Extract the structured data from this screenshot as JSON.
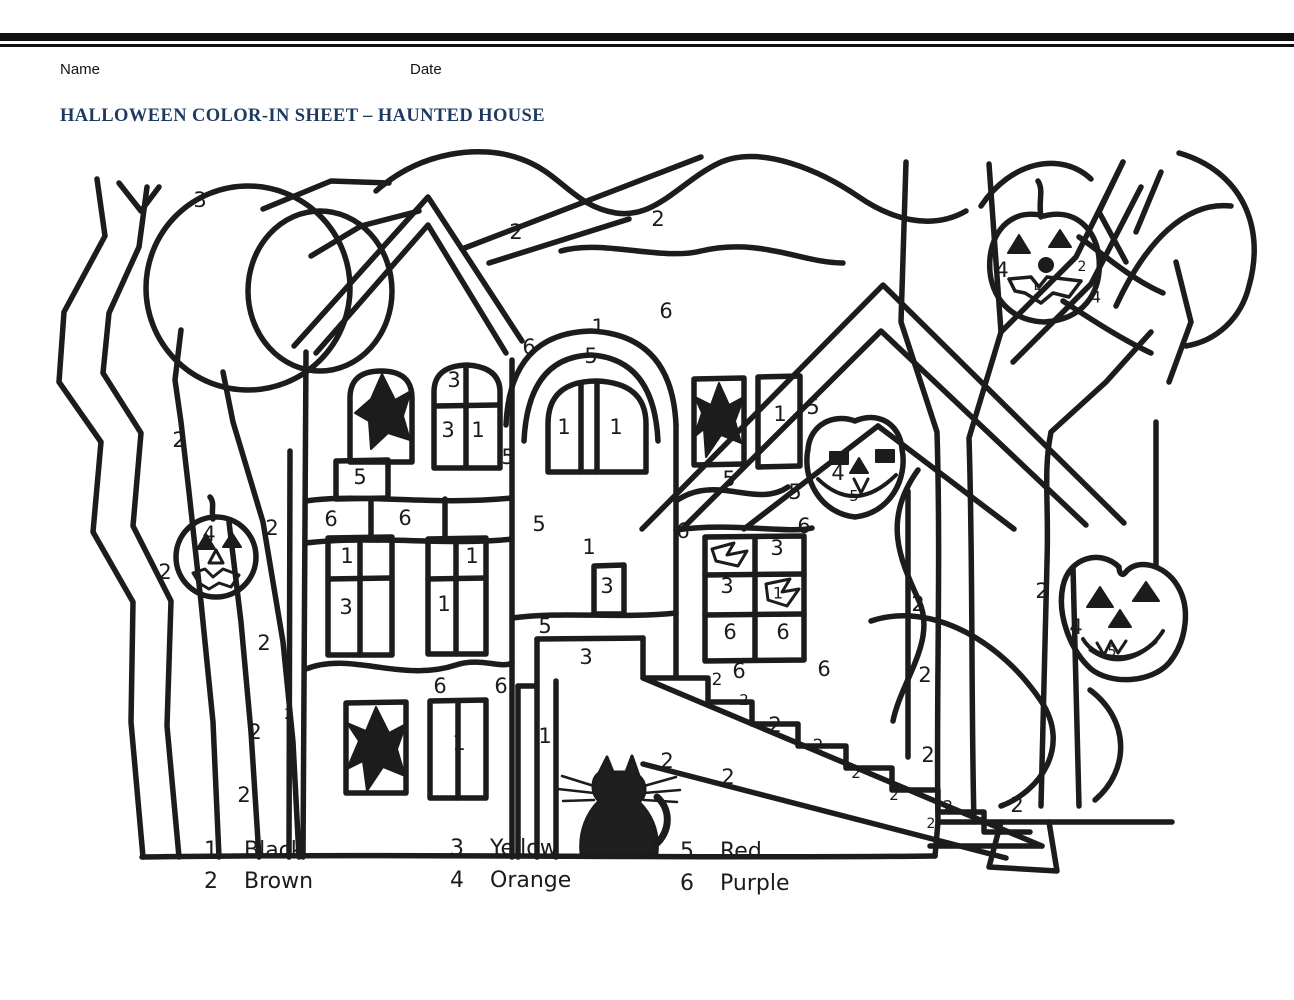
{
  "page": {
    "background": "#ffffff",
    "line_color": "#1c1c1c",
    "title_color": "#1e3a5f"
  },
  "header": {
    "name_label": "Name",
    "date_label": "Date",
    "title": "HALLOWEEN COLOR-IN SHEET – HAUNTED HOUSE"
  },
  "legend": {
    "items": [
      {
        "number": "1",
        "color": "Black"
      },
      {
        "number": "2",
        "color": "Brown"
      },
      {
        "number": "3",
        "color": "Yellow"
      },
      {
        "number": "4",
        "color": "Orange"
      },
      {
        "number": "5",
        "color": "Red"
      },
      {
        "number": "6",
        "color": "Purple"
      }
    ]
  },
  "drawing": {
    "subject": "haunted house color-by-number line art with trees, moon, jack-o-lanterns, black cat and stairs",
    "region_labels": [
      {
        "n": "3",
        "x": 200,
        "y": 200
      },
      {
        "n": "2",
        "x": 516,
        "y": 232
      },
      {
        "n": "2",
        "x": 658,
        "y": 219
      },
      {
        "n": "2",
        "x": 179,
        "y": 440
      },
      {
        "n": "4",
        "x": 209,
        "y": 534
      },
      {
        "n": "2",
        "x": 165,
        "y": 572
      },
      {
        "n": "2",
        "x": 272,
        "y": 528
      },
      {
        "n": "2",
        "x": 264,
        "y": 643
      },
      {
        "n": "2",
        "x": 289,
        "y": 714,
        "s": 15
      },
      {
        "n": "2",
        "x": 255,
        "y": 732
      },
      {
        "n": "2",
        "x": 244,
        "y": 795
      },
      {
        "n": "3",
        "x": 454,
        "y": 380
      },
      {
        "n": "3",
        "x": 448,
        "y": 430
      },
      {
        "n": "1",
        "x": 478,
        "y": 430
      },
      {
        "n": "5",
        "x": 508,
        "y": 457
      },
      {
        "n": "5",
        "x": 360,
        "y": 477
      },
      {
        "n": "6",
        "x": 331,
        "y": 519
      },
      {
        "n": "6",
        "x": 405,
        "y": 518
      },
      {
        "n": "1",
        "x": 347,
        "y": 556
      },
      {
        "n": "3",
        "x": 346,
        "y": 607
      },
      {
        "n": "1",
        "x": 472,
        "y": 556
      },
      {
        "n": "1",
        "x": 444,
        "y": 604
      },
      {
        "n": "6",
        "x": 440,
        "y": 686
      },
      {
        "n": "6",
        "x": 501,
        "y": 686
      },
      {
        "n": "1",
        "x": 459,
        "y": 743
      },
      {
        "n": "6",
        "x": 529,
        "y": 347
      },
      {
        "n": "1",
        "x": 598,
        "y": 327
      },
      {
        "n": "5",
        "x": 591,
        "y": 356
      },
      {
        "n": "1",
        "x": 564,
        "y": 427
      },
      {
        "n": "1",
        "x": 616,
        "y": 427
      },
      {
        "n": "5",
        "x": 539,
        "y": 524
      },
      {
        "n": "1",
        "x": 589,
        "y": 547
      },
      {
        "n": "3",
        "x": 607,
        "y": 586
      },
      {
        "n": "5",
        "x": 545,
        "y": 626
      },
      {
        "n": "3",
        "x": 586,
        "y": 657
      },
      {
        "n": "1",
        "x": 545,
        "y": 736
      },
      {
        "n": "6",
        "x": 666,
        "y": 311
      },
      {
        "n": "5",
        "x": 729,
        "y": 479
      },
      {
        "n": "1",
        "x": 780,
        "y": 414
      },
      {
        "n": "5",
        "x": 813,
        "y": 407
      },
      {
        "n": "5",
        "x": 795,
        "y": 492
      },
      {
        "n": "6",
        "x": 683,
        "y": 531
      },
      {
        "n": "6",
        "x": 804,
        "y": 526
      },
      {
        "n": "3",
        "x": 777,
        "y": 548
      },
      {
        "n": "3",
        "x": 727,
        "y": 586
      },
      {
        "n": "1",
        "x": 778,
        "y": 593,
        "s": 16
      },
      {
        "n": "6",
        "x": 730,
        "y": 632
      },
      {
        "n": "6",
        "x": 783,
        "y": 632
      },
      {
        "n": "6",
        "x": 739,
        "y": 671
      },
      {
        "n": "6",
        "x": 824,
        "y": 669
      },
      {
        "n": "4",
        "x": 838,
        "y": 473
      },
      {
        "n": "5",
        "x": 854,
        "y": 496,
        "s": 15
      },
      {
        "n": "2",
        "x": 667,
        "y": 761
      },
      {
        "n": "2",
        "x": 717,
        "y": 680,
        "s": 17
      },
      {
        "n": "2",
        "x": 744,
        "y": 700,
        "s": 15
      },
      {
        "n": "2",
        "x": 728,
        "y": 777
      },
      {
        "n": "2",
        "x": 775,
        "y": 725
      },
      {
        "n": "2",
        "x": 818,
        "y": 746,
        "s": 17
      },
      {
        "n": "2",
        "x": 856,
        "y": 773,
        "s": 15
      },
      {
        "n": "2",
        "x": 894,
        "y": 795,
        "s": 15
      },
      {
        "n": "2",
        "x": 928,
        "y": 755
      },
      {
        "n": "2",
        "x": 948,
        "y": 806,
        "s": 16
      },
      {
        "n": "2",
        "x": 931,
        "y": 824,
        "s": 14
      },
      {
        "n": "2",
        "x": 1017,
        "y": 805
      },
      {
        "n": "2",
        "x": 918,
        "y": 604
      },
      {
        "n": "2",
        "x": 925,
        "y": 675
      },
      {
        "n": "2",
        "x": 1042,
        "y": 591
      },
      {
        "n": "4",
        "x": 1002,
        "y": 270
      },
      {
        "n": "5",
        "x": 1038,
        "y": 291,
        "s": 15
      },
      {
        "n": "2",
        "x": 1082,
        "y": 267,
        "s": 14
      },
      {
        "n": "4",
        "x": 1096,
        "y": 297,
        "s": 16
      },
      {
        "n": "4",
        "x": 1076,
        "y": 627
      },
      {
        "n": "5",
        "x": 1112,
        "y": 652,
        "s": 14
      }
    ]
  }
}
